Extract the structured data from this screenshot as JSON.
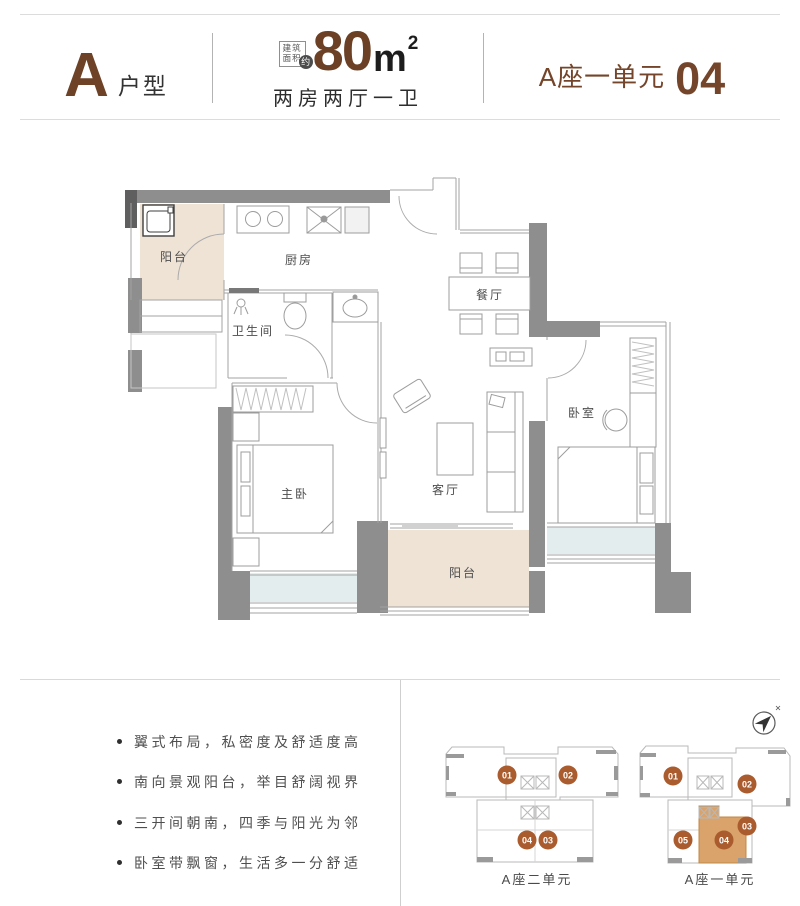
{
  "header": {
    "unit_letter": "A",
    "unit_word": "户型",
    "area_badge_line1": "建筑",
    "area_badge_line2": "面积",
    "area_badge_circle": "约",
    "area_value": "80",
    "area_unit": "m",
    "area_sup": "2",
    "layout_desc": "两房两厅一卫",
    "block_label": "A座一单元",
    "unit_number": "04"
  },
  "floor_plan": {
    "rooms": [
      {
        "name": "balcony-north",
        "label": "阳台"
      },
      {
        "name": "kitchen",
        "label": "厨房"
      },
      {
        "name": "bathroom",
        "label": "卫生间"
      },
      {
        "name": "dining",
        "label": "餐厅"
      },
      {
        "name": "master-bedroom",
        "label": "主卧"
      },
      {
        "name": "living-room",
        "label": "客厅"
      },
      {
        "name": "bedroom",
        "label": "卧室"
      },
      {
        "name": "balcony-south",
        "label": "阳台"
      }
    ]
  },
  "features": [
    "翼式布局，私密度及舒适度高",
    "南向景观阳台，举目舒阔视界",
    "三开间朝南，四季与阳光为邻",
    "卧室带飘窗，生活多一分舒适"
  ],
  "key_plans": {
    "left": {
      "label": "A座二单元",
      "units": [
        "01",
        "02",
        "04",
        "03"
      ]
    },
    "right": {
      "label": "A座一单元",
      "units": [
        "01",
        "02",
        "03",
        "05",
        "04"
      ],
      "highlighted_unit": "04"
    }
  },
  "colors": {
    "accent_brown": "#6d4226",
    "badge_orange": "#aa5c2e",
    "highlight_tan": "#d9a36b",
    "wall_gray": "#8e8e8e",
    "balcony_beige": "#efe3d6",
    "baywindow_cyan": "#e3eded"
  }
}
